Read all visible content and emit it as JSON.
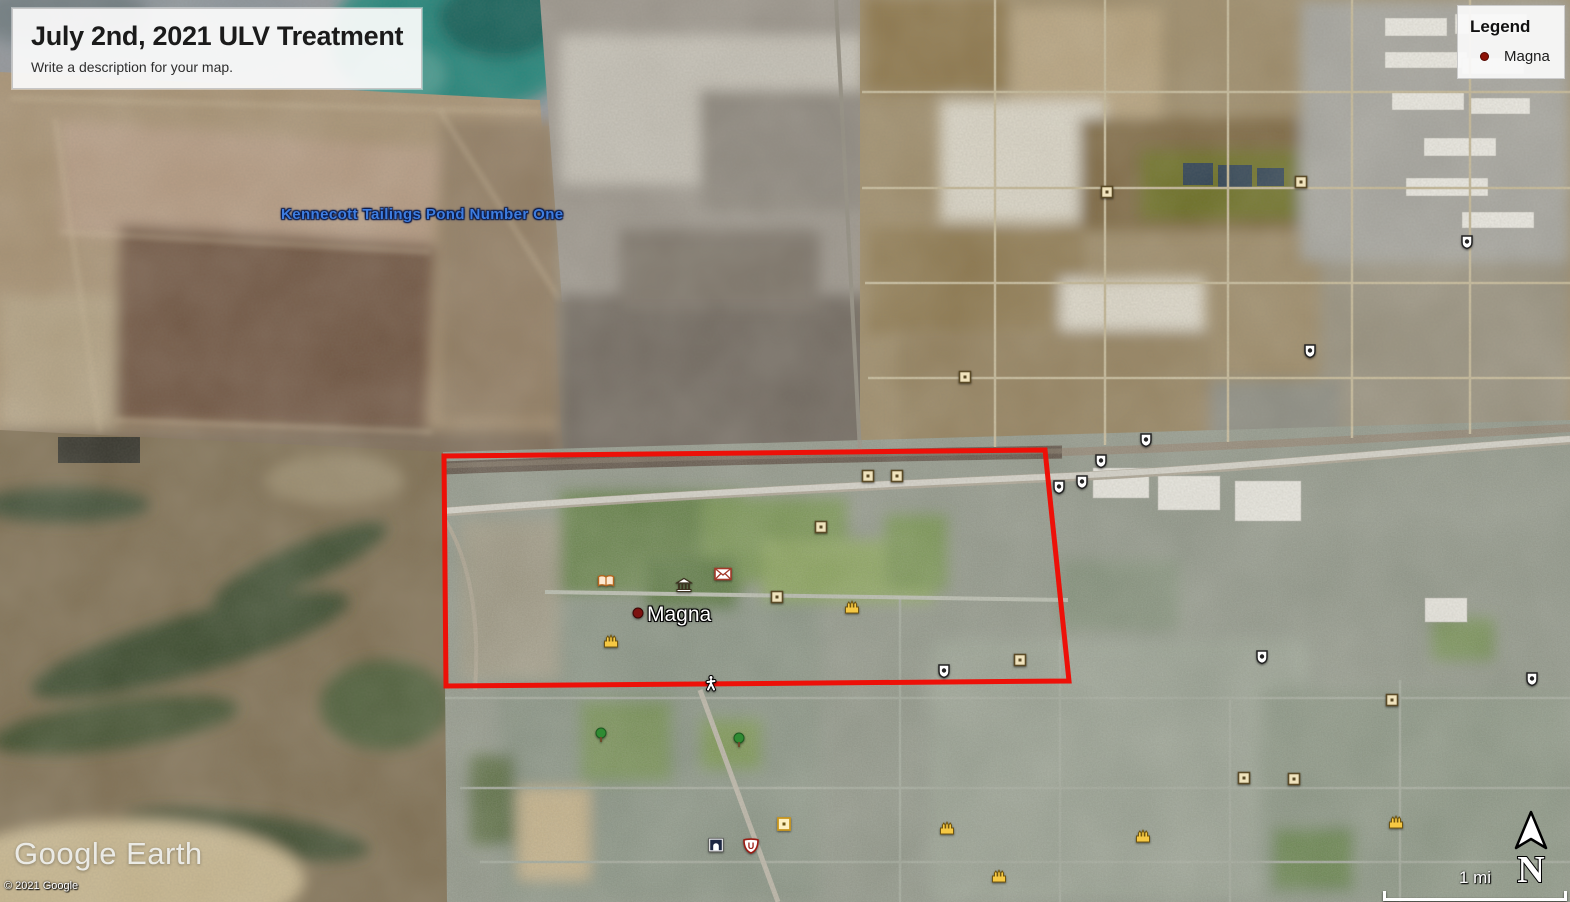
{
  "title_box": {
    "title": "July 2nd, 2021 ULV Treatment",
    "subtitle": "Write a description for your map."
  },
  "legend": {
    "title": "Legend",
    "items": [
      {
        "label": "Magna",
        "marker_color": "#8e1207"
      }
    ]
  },
  "map": {
    "labels": [
      {
        "id": "kennecott-tailings-pond-label",
        "text": "Kennecott Tailings Pond Number One",
        "x": 281,
        "y": 206,
        "style": "imagery-blue",
        "color": "#3e7de0",
        "interactable": "false"
      },
      {
        "id": "magna-place-label",
        "text": "Magna",
        "x": 647,
        "y": 603,
        "style": "place-white",
        "color": "#ffffff",
        "interactable": "true"
      }
    ],
    "treatment_area": {
      "name": "ulv-treatment-area-outline",
      "stroke_color": "#ed1008",
      "stroke_width": 5,
      "points": [
        [
          444,
          456
        ],
        [
          1045,
          450
        ],
        [
          1069,
          681
        ],
        [
          446,
          686
        ]
      ]
    },
    "icons": [
      {
        "type": "place-dot",
        "x": 638,
        "y": 613
      },
      {
        "type": "book",
        "x": 606,
        "y": 581
      },
      {
        "type": "museum",
        "x": 684,
        "y": 585
      },
      {
        "type": "mail",
        "x": 723,
        "y": 574
      },
      {
        "type": "square-poi",
        "x": 868,
        "y": 476
      },
      {
        "type": "square-poi",
        "x": 897,
        "y": 476
      },
      {
        "type": "square-poi",
        "x": 821,
        "y": 527
      },
      {
        "type": "square-poi",
        "x": 777,
        "y": 597
      },
      {
        "type": "square-poi",
        "x": 1020,
        "y": 660
      },
      {
        "type": "square-poi",
        "x": 1107,
        "y": 192
      },
      {
        "type": "square-poi",
        "x": 1301,
        "y": 182
      },
      {
        "type": "square-poi",
        "x": 1244,
        "y": 778
      },
      {
        "type": "square-poi",
        "x": 1294,
        "y": 779
      },
      {
        "type": "square-poi",
        "x": 1392,
        "y": 700
      },
      {
        "type": "square-poi",
        "x": 965,
        "y": 377
      },
      {
        "type": "temple",
        "x": 611,
        "y": 641
      },
      {
        "type": "temple",
        "x": 852,
        "y": 607
      },
      {
        "type": "temple",
        "x": 947,
        "y": 828
      },
      {
        "type": "temple",
        "x": 999,
        "y": 876
      },
      {
        "type": "temple",
        "x": 1143,
        "y": 836
      },
      {
        "type": "temple",
        "x": 1396,
        "y": 822
      },
      {
        "type": "route-shield",
        "x": 1146,
        "y": 440
      },
      {
        "type": "route-shield",
        "x": 1101,
        "y": 461
      },
      {
        "type": "route-shield",
        "x": 1059,
        "y": 487
      },
      {
        "type": "route-shield",
        "x": 1082,
        "y": 482
      },
      {
        "type": "route-shield",
        "x": 944,
        "y": 671
      },
      {
        "type": "route-shield",
        "x": 1262,
        "y": 657
      },
      {
        "type": "route-shield",
        "x": 1310,
        "y": 351
      },
      {
        "type": "route-shield",
        "x": 1467,
        "y": 242
      },
      {
        "type": "route-shield",
        "x": 1532,
        "y": 679
      },
      {
        "type": "park-tree",
        "x": 601,
        "y": 735
      },
      {
        "type": "park-tree",
        "x": 739,
        "y": 740
      },
      {
        "type": "pedestrian",
        "x": 711,
        "y": 683
      },
      {
        "type": "u-shield",
        "x": 751,
        "y": 846
      },
      {
        "type": "building-dark",
        "x": 716,
        "y": 845
      },
      {
        "type": "yellow-square",
        "x": 784,
        "y": 824
      }
    ]
  },
  "attribution": {
    "logo": "Google Earth",
    "copyright": "© 2021 Google"
  },
  "scale_bar": {
    "label": "1 mi"
  },
  "compass": {
    "label": "N"
  }
}
